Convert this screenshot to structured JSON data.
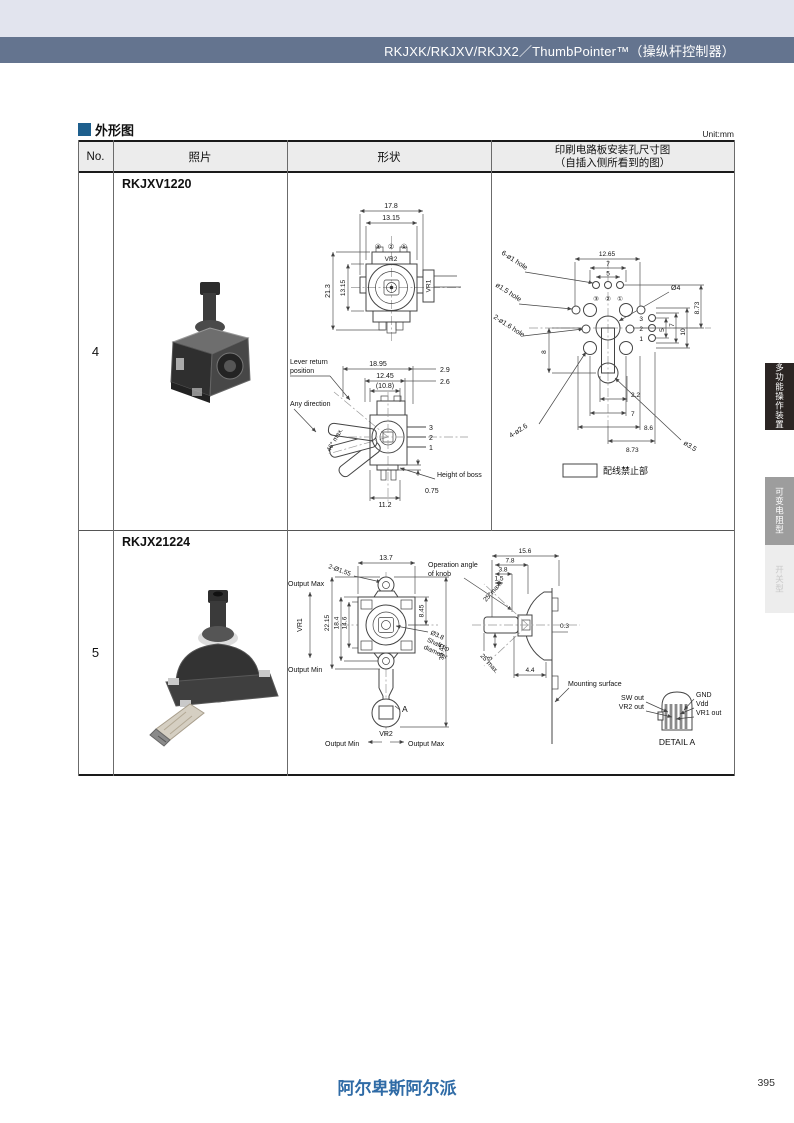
{
  "colors": {
    "top_band": "#e2e4ee",
    "header_bar": "#64748f",
    "section_square": "#1e5f8d",
    "logo_blue": "#2f6ba6",
    "tab_dark": "#2b2523",
    "tab_gray": "#9d9d9d",
    "tab_light": "#ededed"
  },
  "header": {
    "title": "RKJXK/RKJXV/RKJX2／ThumbPointer™（操纵杆控制器）"
  },
  "section": {
    "title": "外形图",
    "unit": "Unit:mm"
  },
  "table": {
    "col_no": "No.",
    "col_photo": "照片",
    "col_shape": "形状",
    "col_pcb_line1": "印刷电路板安装孔尺寸图",
    "col_pcb_line2": "（自插入侧所看到的图）"
  },
  "row4": {
    "no": "4",
    "model": "RKJXV1220",
    "top": {
      "w_outer": "17.8",
      "w_inner": "13.15",
      "h_outer": "21.3",
      "h_inner": "13.15",
      "c3": "③",
      "c2": "②",
      "c1": "①",
      "vr2": "VR2",
      "vr1": "VR1"
    },
    "side": {
      "lever1": "Lever return",
      "lever2": "position",
      "any": "Any direction",
      "angle": "46° max.",
      "d1": "18.95",
      "d2": "12.45",
      "d3": "(10.8)",
      "d4": "2.9",
      "d5": "2.6",
      "p3": "3",
      "p2": "2",
      "p1": "1",
      "boss": "Height of boss",
      "d6": "0.75",
      "d7": "11.2"
    },
    "pcb": {
      "l1": "6-ø1 hole",
      "l2": "ø1.5 hole",
      "l3": "2-ø1.6 hole",
      "l4": "Ø4",
      "l5": "4-ø2.6",
      "l6": "ø3.5",
      "t1": "12.65",
      "t2": "7",
      "t3": "5",
      "r1": "8.73",
      "r2": "10",
      "r3": "7",
      "r4": "5",
      "left8": "8",
      "b1": "2.2",
      "b2": "7",
      "b3": "8.6",
      "b4": "8.73",
      "p3": "3",
      "p2": "2",
      "p1": "1",
      "c3": "③",
      "c2": "②",
      "c1": "①",
      "legend": "配线禁止部"
    }
  },
  "row5": {
    "no": "5",
    "model": "RKJX21224",
    "front": {
      "hole": "2-Ø1.55",
      "d_top": "13.7",
      "omax": "Output Max",
      "omin": "Output Min",
      "vr1": "VR1",
      "d1": "22.15",
      "d2": "18.4",
      "d3": "14.6",
      "d4": "8.45",
      "d5": "33.45",
      "shaft1": "Ø3.8",
      "shaft2": "Shaft tip",
      "shaft3": "diameter",
      "a": "A",
      "vr2": "VR2",
      "bmin": "Output Min",
      "bmax": "Output Max"
    },
    "side": {
      "d1": "15.6",
      "d2": "7.8",
      "d3": "3.8",
      "d4": "1.5",
      "op1": "Operation angle",
      "op2": "of knob",
      "ang1": "25°max.",
      "ang2": "25°max.",
      "d5": "3",
      "d6": "0.3",
      "d7": "4.4",
      "mount": "Mounting surface"
    },
    "detail": {
      "sw": "SW out",
      "vr2": "VR2 out",
      "gnd": "GND",
      "vdd": "Vdd",
      "vr1": "VR1 out",
      "caption": "DETAIL A"
    }
  },
  "tabs": [
    {
      "label": "多功能操作装置"
    },
    {
      "label": "可变电阻型"
    },
    {
      "label": "开关型"
    }
  ],
  "footer": {
    "logo": "阿尔卑斯阿尔派",
    "page": "395"
  }
}
